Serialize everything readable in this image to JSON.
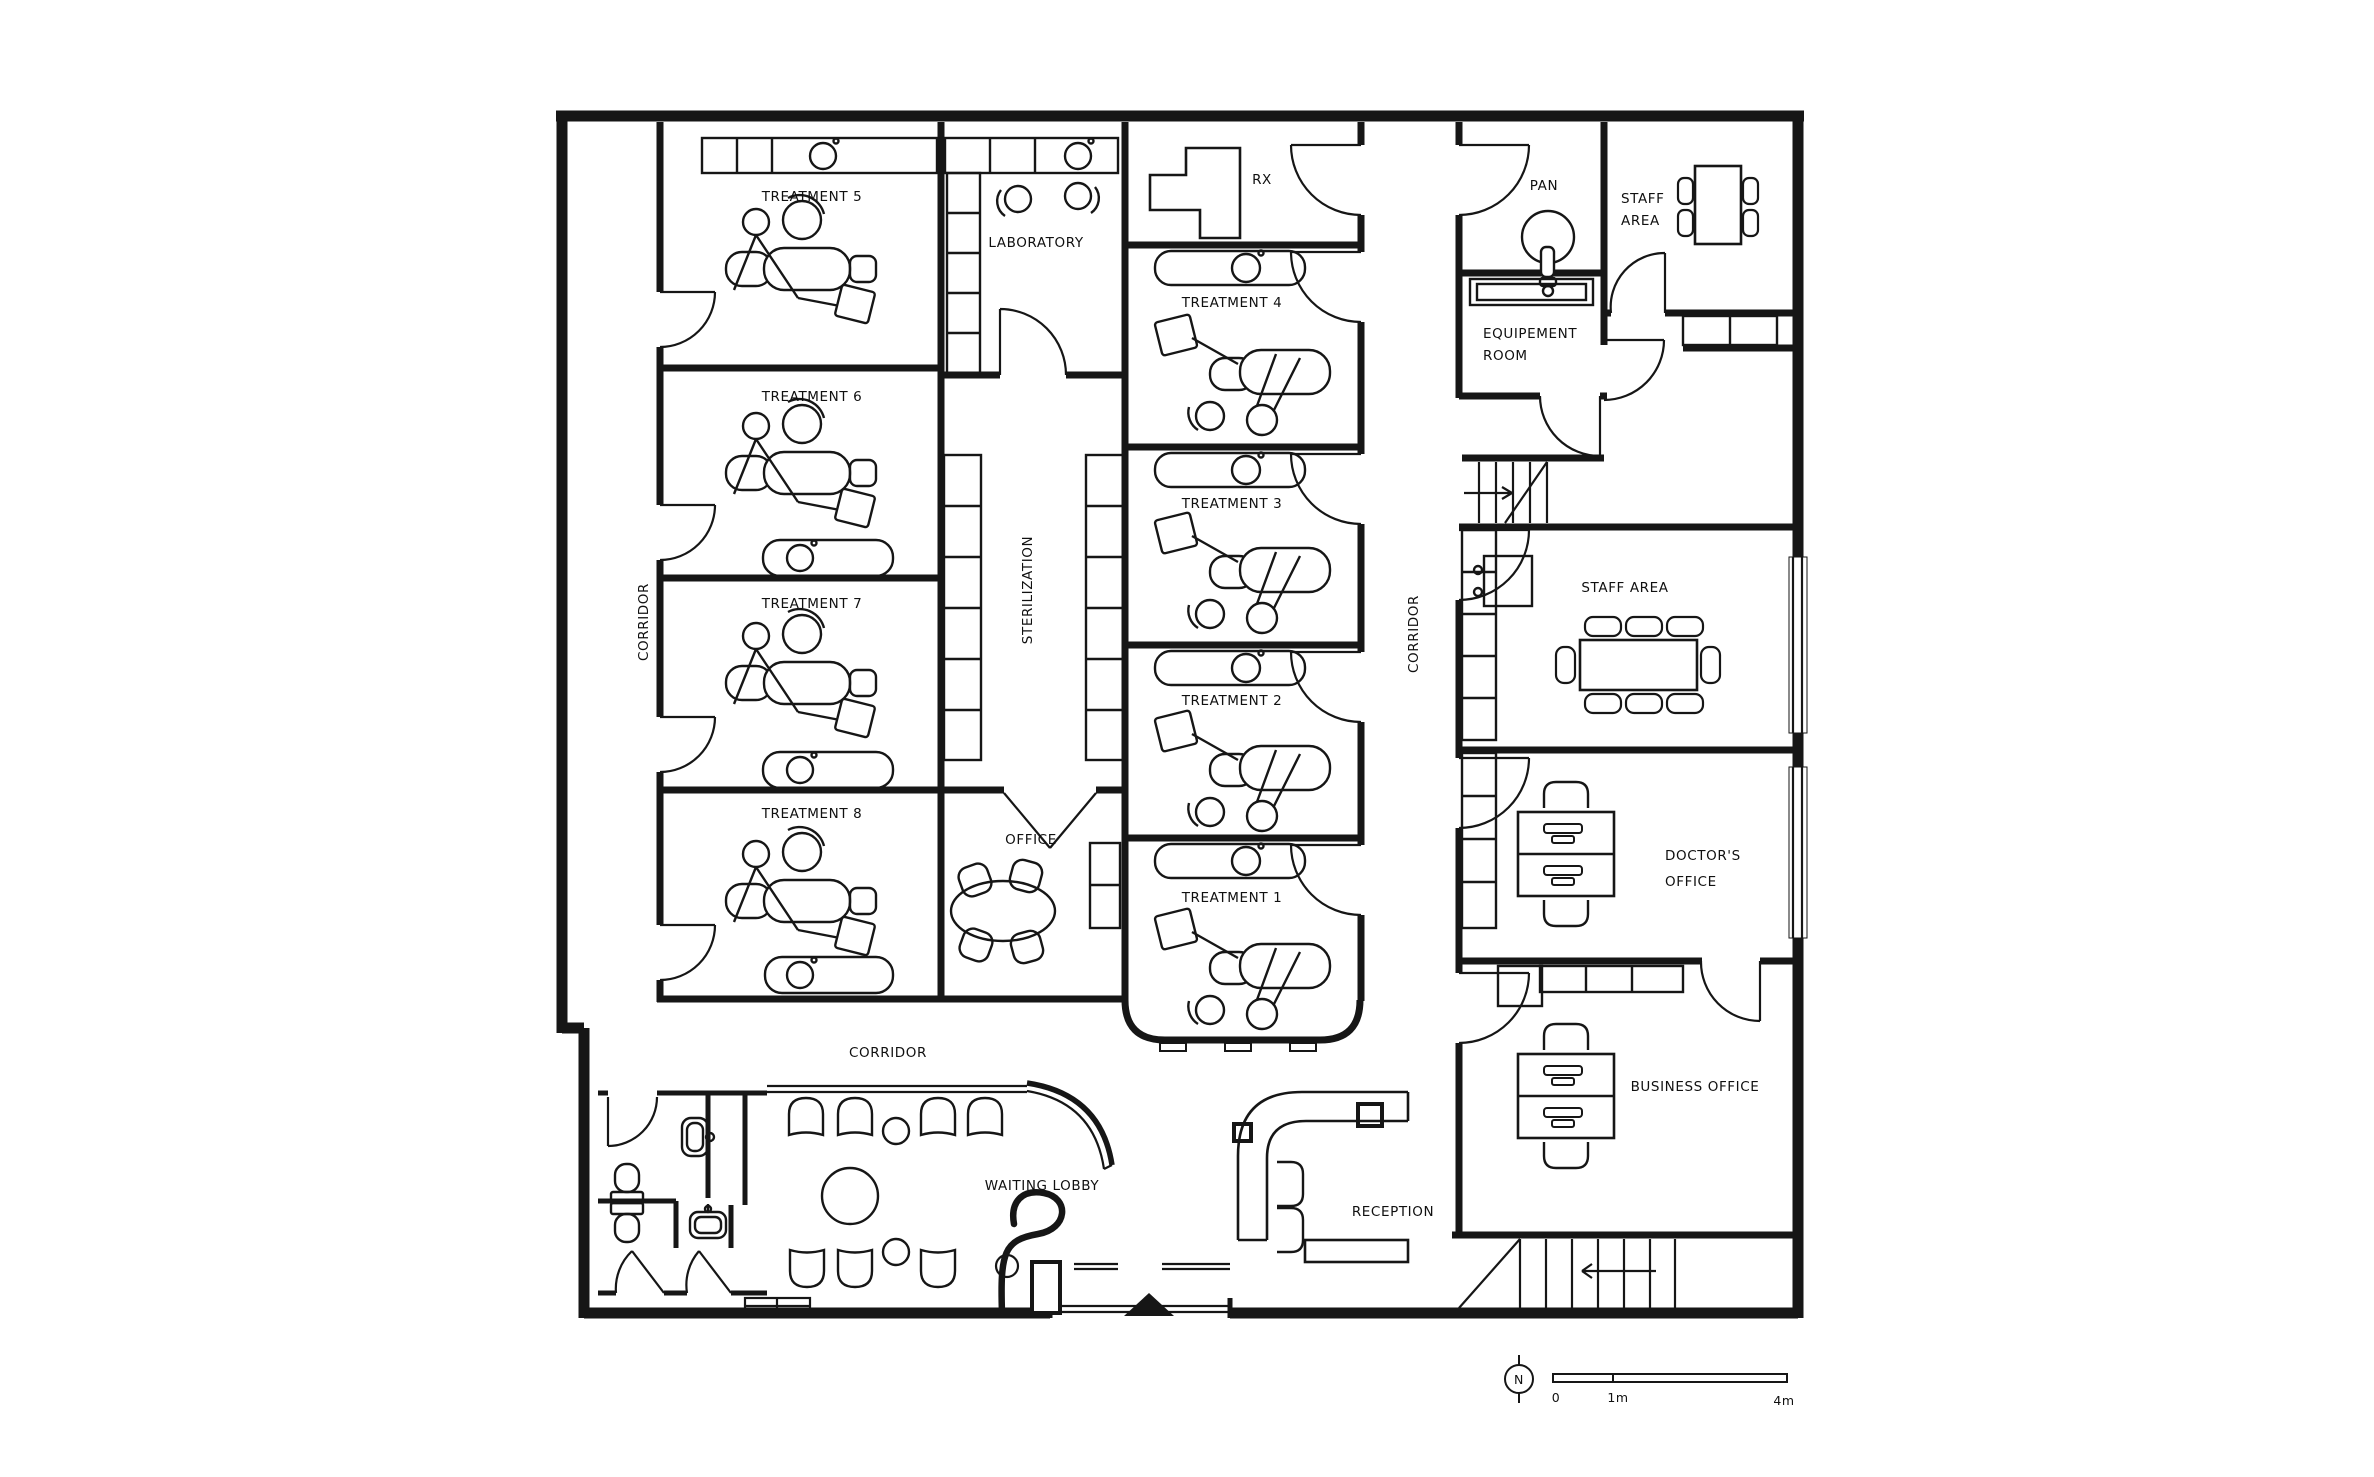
{
  "plan": {
    "title": "Dental clinic floor plan",
    "rooms": {
      "treatment_5": {
        "label": "TREATMENT 5"
      },
      "treatment_6": {
        "label": "TREATMENT 6"
      },
      "treatment_7": {
        "label": "TREATMENT 7"
      },
      "treatment_8": {
        "label": "TREATMENT 8"
      },
      "laboratory": {
        "label": "LABORATORY"
      },
      "sterilization": {
        "label": "STERILIZATION"
      },
      "office": {
        "label": "OFFICE"
      },
      "rx": {
        "label": "RX"
      },
      "treatment_4": {
        "label": "TREATMENT 4"
      },
      "treatment_3": {
        "label": "TREATMENT 3"
      },
      "treatment_2": {
        "label": "TREATMENT 2"
      },
      "treatment_1": {
        "label": "TREATMENT 1"
      },
      "pan": {
        "label": "PAN"
      },
      "staff_area_top": {
        "line1": "STAFF",
        "line2": "AREA"
      },
      "equipement_room": {
        "line1": "EQUIPEMENT",
        "line2": "ROOM"
      },
      "staff_area": {
        "label": "STAFF AREA"
      },
      "doctors_office": {
        "line1": "DOCTOR'S",
        "line2": "OFFICE"
      },
      "business_office": {
        "label": "BUSINESS OFFICE"
      },
      "waiting_lobby": {
        "label": "WAITING LOBBY"
      },
      "reception": {
        "label": "RECEPTION"
      }
    },
    "corridors": {
      "left": "CORRIDOR",
      "right": "CORRIDOR",
      "bottom": "CORRIDOR"
    },
    "legend": {
      "compass_north": "N",
      "scale_zero": "0",
      "scale_one": "1m",
      "scale_four": "4m"
    },
    "colors": {
      "ink": "#161616",
      "paper": "#ffffff"
    }
  }
}
